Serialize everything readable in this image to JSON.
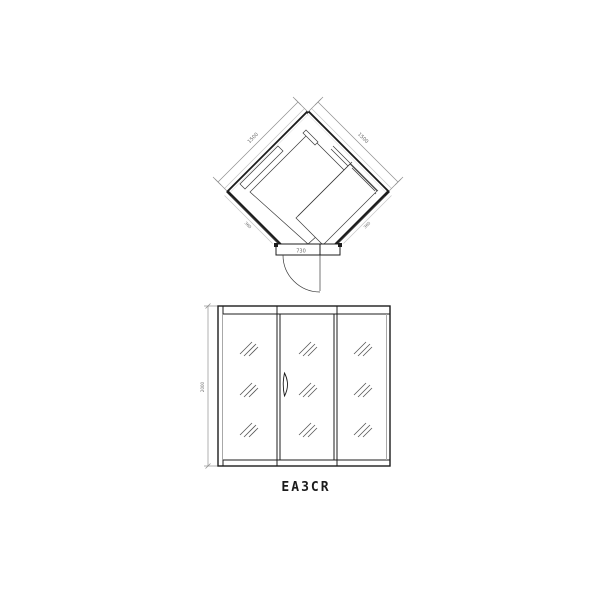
{
  "model_label": "EA3CR",
  "plan_view": {
    "dimensions": {
      "back_wall_left": "1500",
      "back_wall_right": "1500",
      "door_width": "730",
      "front_glass_left": "360",
      "front_glass_right": "360"
    }
  },
  "elevation_view": {
    "dimensions": {
      "height": "2000"
    }
  },
  "colors": {
    "line": "#1c1c1c",
    "dimension": "#8f8f8f",
    "dimension_text": "#666666",
    "background": "#ffffff"
  }
}
